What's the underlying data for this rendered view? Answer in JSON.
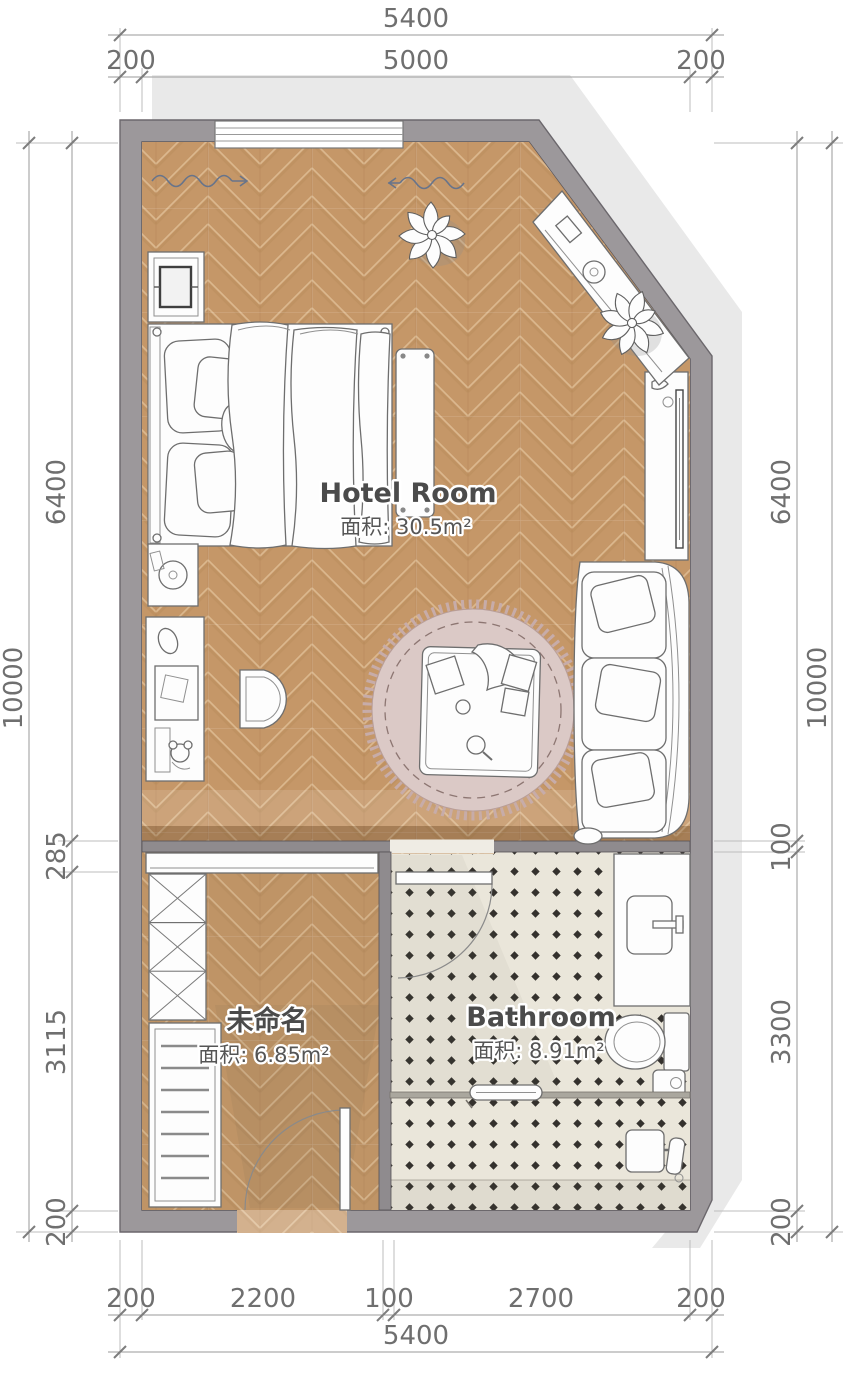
{
  "rooms": {
    "hotel_room": {
      "name": "Hotel Room",
      "area": "面积: 30.5m²"
    },
    "unnamed": {
      "name": "未命名",
      "area": "面积: 6.85m²"
    },
    "bathroom": {
      "name": "Bathroom",
      "area": "面积: 8.91m²"
    }
  },
  "dimensions": {
    "top": {
      "total": "5400",
      "segments": [
        "200",
        "5000",
        "200"
      ]
    },
    "bottom": {
      "total": "5400",
      "segments": [
        "200",
        "2200",
        "100",
        "2700",
        "200"
      ]
    },
    "left": {
      "total": "10000",
      "segments": [
        "6400",
        "285",
        "3115",
        "200"
      ]
    },
    "right": {
      "total": "10000",
      "segments": [
        "6400",
        "100",
        "3300",
        "200"
      ]
    }
  },
  "colors": {
    "wall": "#9c989b",
    "wall_outline": "#5f5b60",
    "wood_floor": "#c59768",
    "wood_seam": "#e3c098",
    "tile_floor": "#eae6da",
    "tile_diamond": "#34312d",
    "rug": "#dbc9c6",
    "rug_fringe": "#c7aca9",
    "shadow": "#e9e9e9",
    "dimension_text": "#6f6f6f",
    "label_text": "#4b4b4b"
  }
}
